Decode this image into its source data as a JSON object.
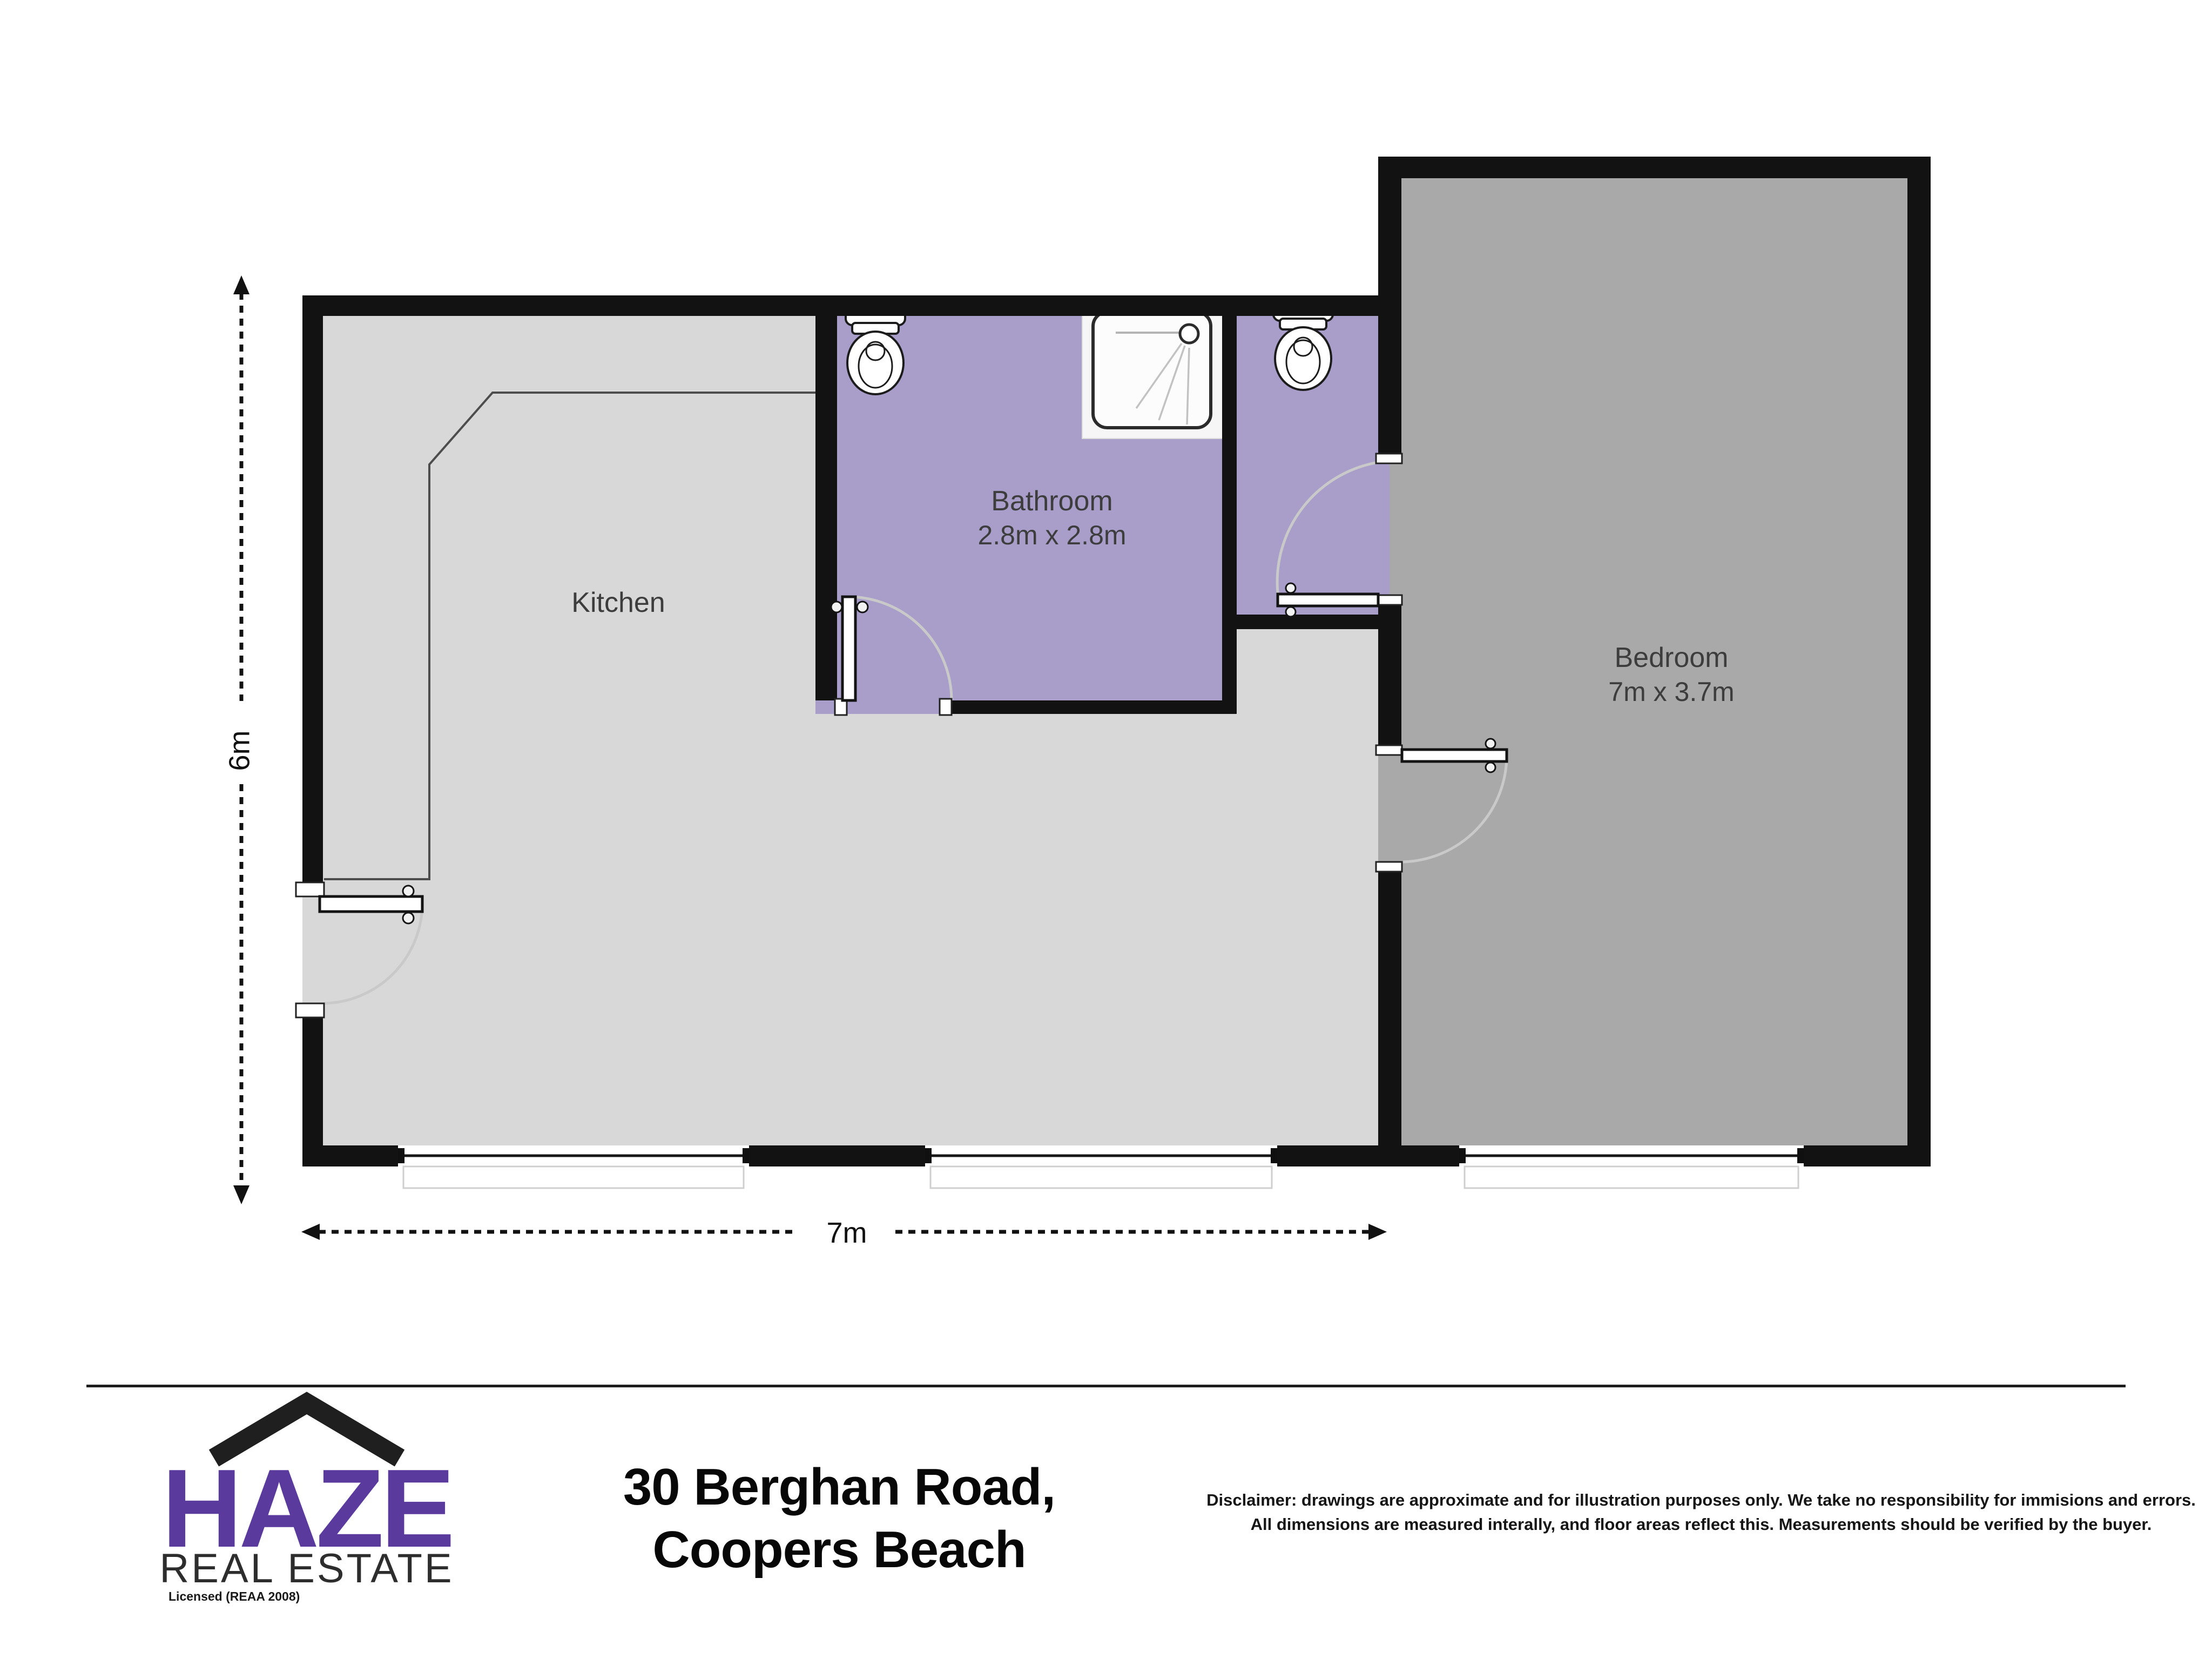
{
  "floorplan": {
    "rooms": {
      "kitchen": {
        "label": "Kitchen"
      },
      "bathroom": {
        "label": "Bathroom",
        "size": "2.8m x 2.8m"
      },
      "bedroom": {
        "label": "Bedroom",
        "size": "7m x 3.7m"
      }
    },
    "dimensions": {
      "width": "7m",
      "height": "6m"
    },
    "colors": {
      "wall": "#121212",
      "floor-living": "#d8d8d8",
      "floor-bedroom": "#a9a9a9",
      "floor-bath": "#a99dc9",
      "door-arc": "#c9c9c9",
      "counter-line": "#4d4d4d",
      "label-text": "#3d3d3d",
      "brand-purple": "#5b3a9e",
      "ink": "#111111"
    }
  },
  "footer": {
    "logo": {
      "brand": "HAZE",
      "subtitle": "REAL ESTATE",
      "license": "Licensed (REAA 2008)"
    },
    "address": {
      "line1": "30 Berghan Road,",
      "line2": "Coopers Beach"
    },
    "disclaimer": {
      "line1": "Disclaimer: drawings are approximate and for illustration purposes only. We take no responsibility for immisions and errors.",
      "line2": "All dimensions are measured interally, and floor areas reflect this. Measurements should be verified by the buyer."
    }
  }
}
